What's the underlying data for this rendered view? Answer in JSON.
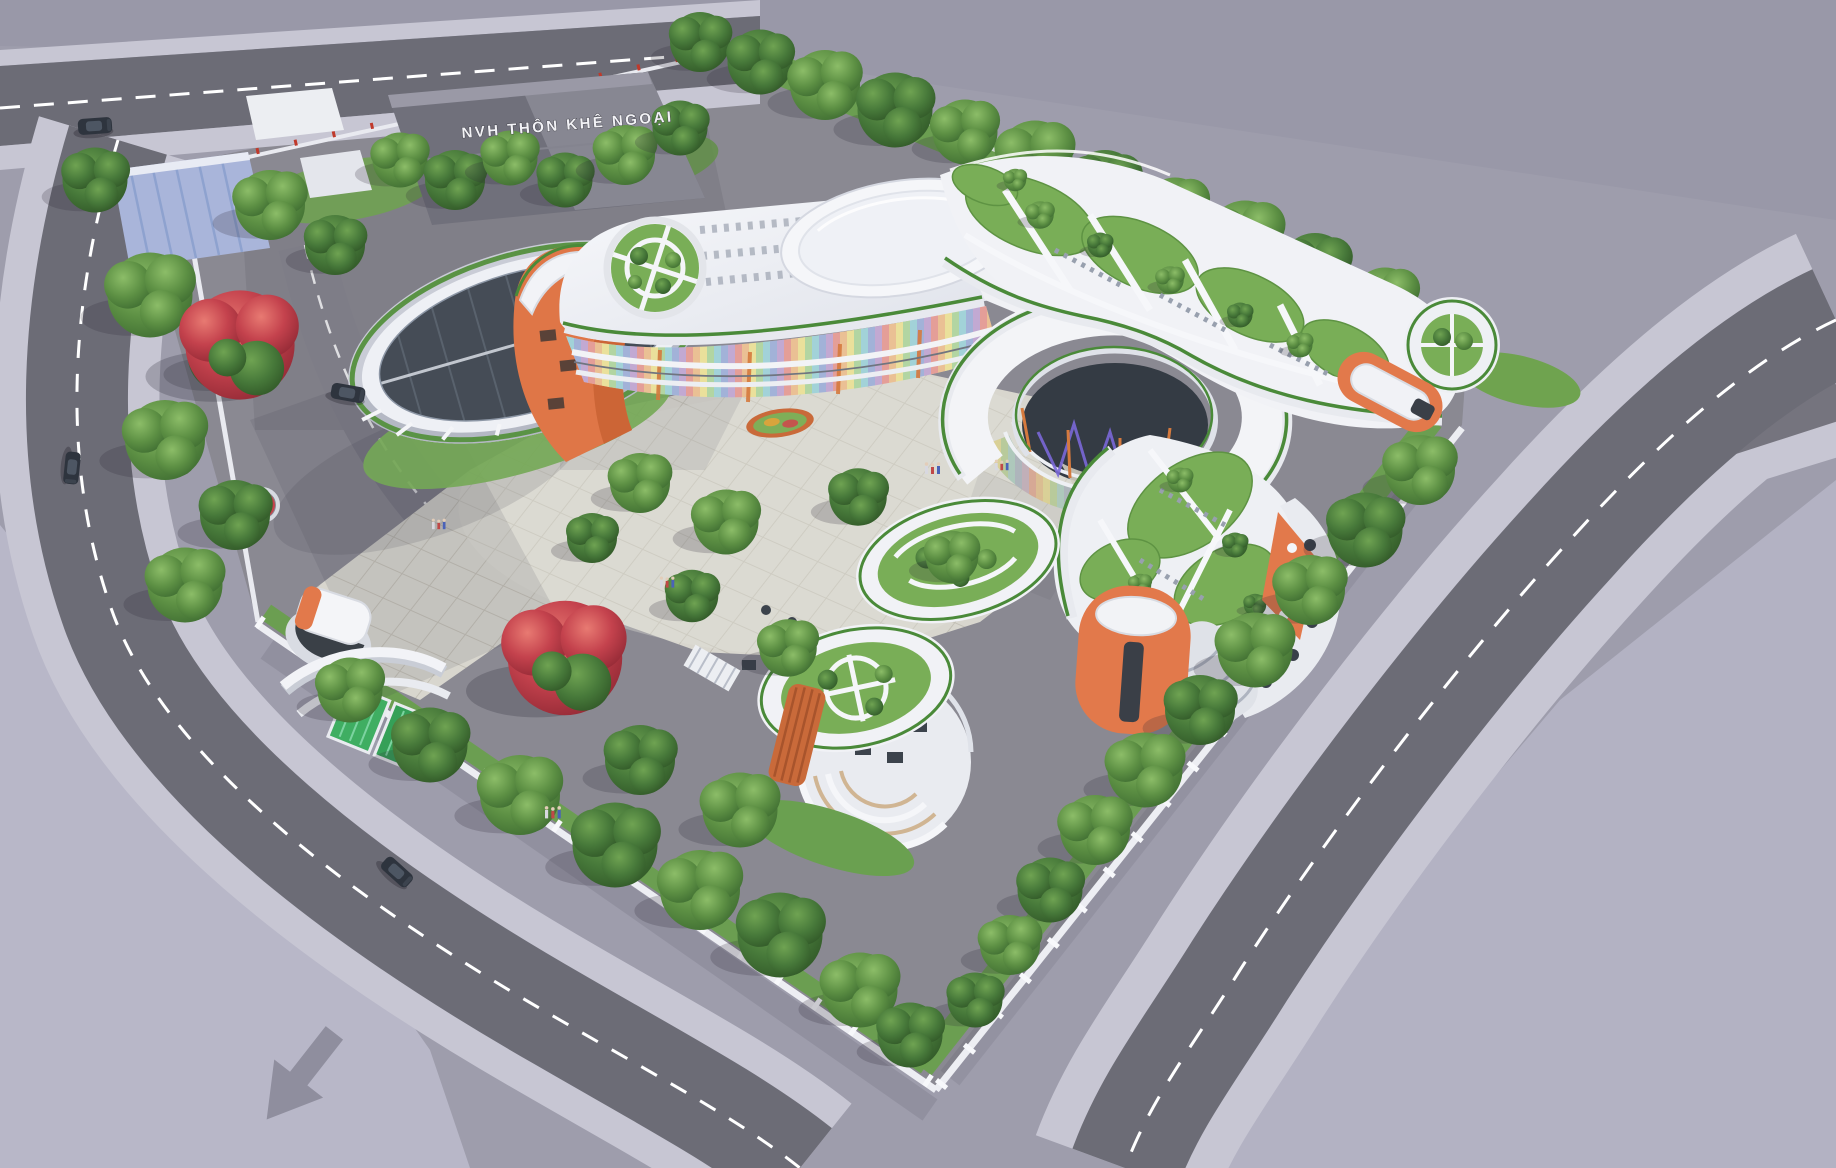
{
  "scene": {
    "label": "NVH THÔN KHÊ NGOẠI",
    "description": "Aerial 3D architectural rendering of a curvilinear kindergarten campus with green roofs, rainbow facade, central courtyard, perimeter roads and tree rows",
    "inventory": {
      "cars": 4,
      "flowering_red_trees": 2,
      "orange_stair_towers": 3,
      "roof_gardens": 4,
      "entrance_gates": 1,
      "people_groups": 5
    }
  },
  "palette": {
    "void_gray": "#9e9dac",
    "empty_lot_lavender": "#b8b7c8",
    "asphalt": "#6c6c76",
    "sidewalk": "#c7c6d3",
    "site_ground": "#8a8992",
    "plaza_paving": "#d8d6ce",
    "roof_white": "#f3f4f7",
    "wall_white": "#e9ebf0",
    "accent_orange": "#e2794b",
    "accent_orange_dark": "#c96334",
    "roof_grass": "#79ae57",
    "green_trim": "#4a8a39",
    "glass_dark": "#454c56",
    "tree_green": "#5d9044",
    "tree_dark": "#47793a",
    "flower_red": "#c4424d",
    "zigzag_purple": "#7a68d8",
    "rainbow": [
      "#e05656",
      "#eb9b4d",
      "#ead95c",
      "#7cc46a",
      "#5bbfd6",
      "#5b7fd6",
      "#9a6cc9"
    ],
    "carport_blue": "#a9b5da",
    "gate_green": "#3fae62",
    "road_marking": "#ffffff"
  }
}
